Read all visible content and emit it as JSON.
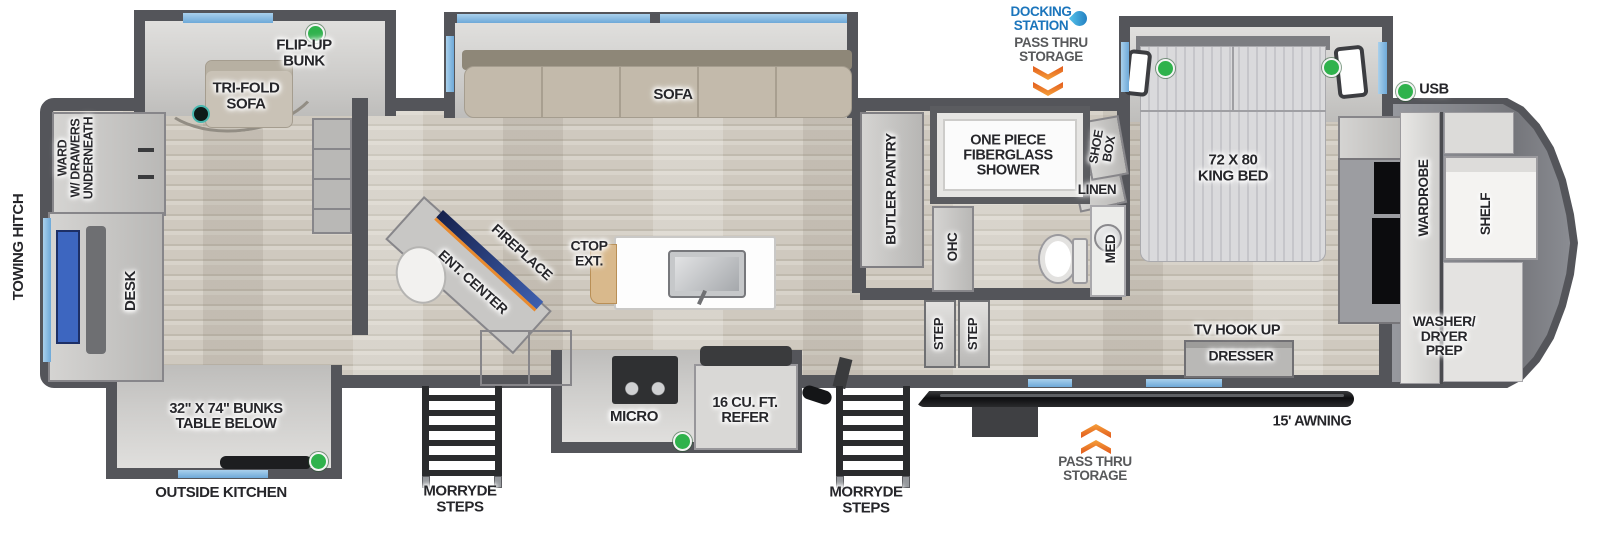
{
  "colors": {
    "wall": "#54555a",
    "window_blue": "#7fb6e0",
    "status_green": "#2fb24c",
    "arrow_orange": "#e8701f",
    "docking_blue": "#1b75bc",
    "floor_wood": "#d3cec5"
  },
  "exterior": {
    "towing_hitch": "TOWING HITCH",
    "docking_station": "DOCKING\nSTATION",
    "pass_thru_top": "PASS THRU\nSTORAGE",
    "pass_thru_bottom": "PASS THRU\nSTORAGE",
    "awning": "15' AWNING",
    "outside_kitchen": "OUTSIDE KITCHEN",
    "morryde_steps_left": "MORRYDE\nSTEPS",
    "morryde_steps_right": "MORRYDE\nSTEPS",
    "usb": "USB"
  },
  "bunk_room": {
    "flip_up_bunk": "FLIP-UP\nBUNK",
    "tri_fold_sofa": "TRI-FOLD\nSOFA",
    "ward": "WARD\nW/ DRAWERS\nUNDERNEATH",
    "desk": "DESK",
    "bunks": "32\" X 74\" BUNKS\nTABLE BELOW"
  },
  "living": {
    "sofa": "SOFA",
    "ent_center": "ENT. CENTER",
    "fireplace": "FIREPLACE",
    "ctop_ext": "CTOP\nEXT.",
    "micro": "MICRO",
    "refer": "16 CU. FT.\nREFER"
  },
  "bath": {
    "butler_pantry": "BUTLER PANTRY",
    "ohc": "OHC",
    "shower": "ONE PIECE\nFIBERGLASS\nSHOWER",
    "shoe_box": "SHOE\nBOX",
    "linen": "LINEN",
    "med": "MED",
    "step_1": "STEP",
    "step_2": "STEP"
  },
  "bedroom": {
    "king_bed": "72 X 80\nKING BED",
    "tv_hook_up": "TV HOOK UP",
    "dresser": "DRESSER",
    "wardrobe": "WARDROBE",
    "shelf": "SHELF",
    "washer_dryer": "WASHER/\nDRYER\nPREP"
  }
}
